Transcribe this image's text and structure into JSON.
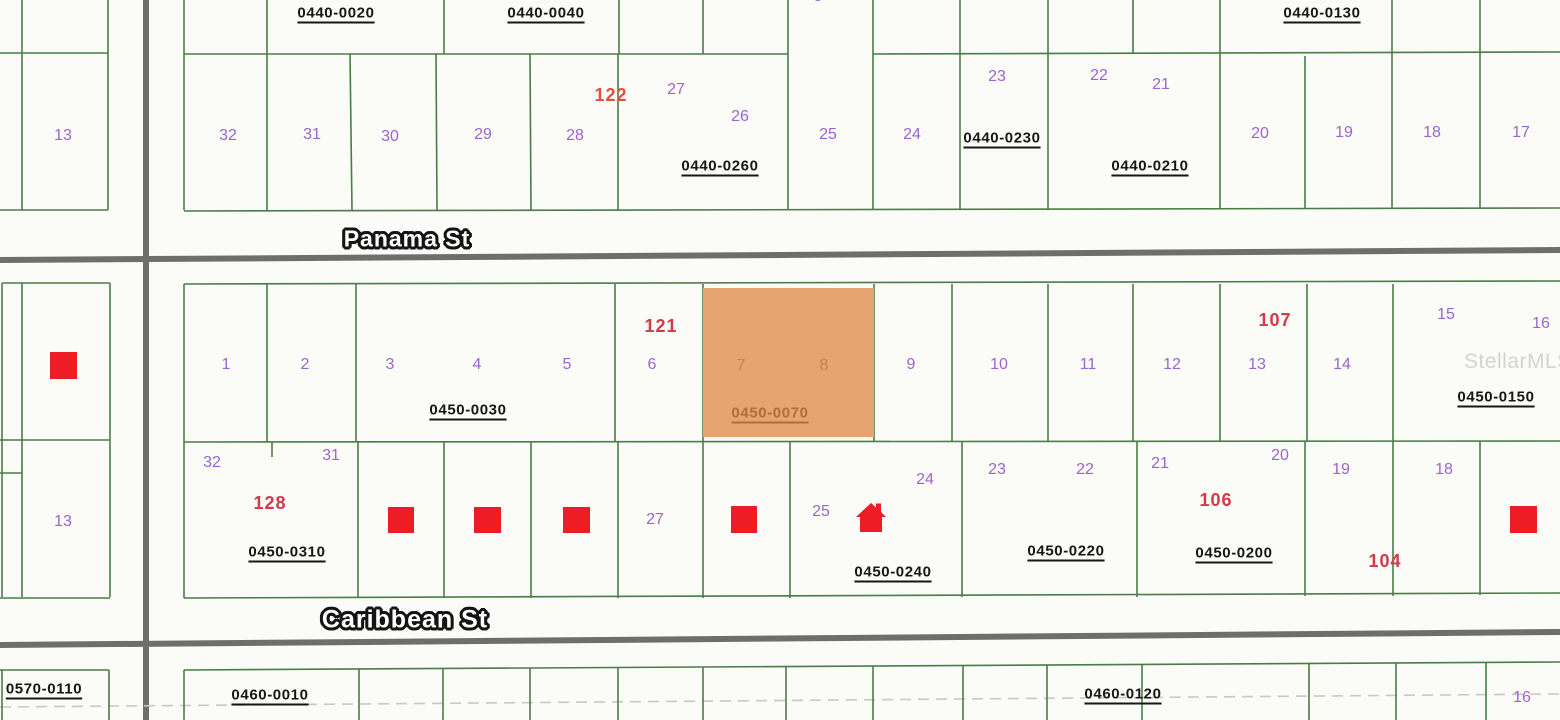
{
  "map": {
    "watermark": "StellarMLS",
    "streets": [
      {
        "name": "Panama St"
      },
      {
        "name": "Caribbean St"
      }
    ],
    "selected_parcel": {
      "id": "0450-0070",
      "fill": "#e8a470",
      "label_color": "#b06f35",
      "lots": [
        {
          "n": "7",
          "x": 741,
          "y": 366
        },
        {
          "n": "8",
          "x": 824,
          "y": 366
        }
      ]
    },
    "parcel_ids": [
      {
        "id": "0440-0020",
        "x": 336,
        "y": 13
      },
      {
        "id": "0440-0040",
        "x": 546,
        "y": 13
      },
      {
        "id": "0440-0130",
        "x": 1322,
        "y": 13
      },
      {
        "id": "0440-0260",
        "x": 720,
        "y": 166
      },
      {
        "id": "0440-0230",
        "x": 1002,
        "y": 138
      },
      {
        "id": "0440-0210",
        "x": 1150,
        "y": 166
      },
      {
        "id": "0450-0030",
        "x": 468,
        "y": 410
      },
      {
        "id": "0450-0150",
        "x": 1496,
        "y": 397
      },
      {
        "id": "0450-0310",
        "x": 287,
        "y": 552
      },
      {
        "id": "0450-0240",
        "x": 893,
        "y": 572
      },
      {
        "id": "0450-0220",
        "x": 1066,
        "y": 551
      },
      {
        "id": "0450-0200",
        "x": 1234,
        "y": 553
      },
      {
        "id": "0570-0110",
        "x": 44,
        "y": 689
      },
      {
        "id": "0460-0010",
        "x": 270,
        "y": 695
      },
      {
        "id": "0460-0120",
        "x": 1123,
        "y": 694
      }
    ],
    "lot_numbers": [
      {
        "n": "13",
        "x": 63,
        "y": 136
      },
      {
        "n": "13",
        "x": 63,
        "y": 522
      },
      {
        "n": "8",
        "x": 818,
        "y": -3
      },
      {
        "n": "32",
        "x": 228,
        "y": 136
      },
      {
        "n": "31",
        "x": 312,
        "y": 135
      },
      {
        "n": "30",
        "x": 390,
        "y": 137
      },
      {
        "n": "29",
        "x": 483,
        "y": 135
      },
      {
        "n": "28",
        "x": 575,
        "y": 136
      },
      {
        "n": "27",
        "x": 676,
        "y": 90
      },
      {
        "n": "26",
        "x": 740,
        "y": 117
      },
      {
        "n": "25",
        "x": 828,
        "y": 135
      },
      {
        "n": "24",
        "x": 912,
        "y": 135
      },
      {
        "n": "23",
        "x": 997,
        "y": 77
      },
      {
        "n": "22",
        "x": 1099,
        "y": 76
      },
      {
        "n": "21",
        "x": 1161,
        "y": 85
      },
      {
        "n": "20",
        "x": 1260,
        "y": 134
      },
      {
        "n": "19",
        "x": 1344,
        "y": 133
      },
      {
        "n": "18",
        "x": 1432,
        "y": 133
      },
      {
        "n": "17",
        "x": 1521,
        "y": 133
      },
      {
        "n": "1",
        "x": 226,
        "y": 365
      },
      {
        "n": "2",
        "x": 305,
        "y": 365
      },
      {
        "n": "3",
        "x": 390,
        "y": 365
      },
      {
        "n": "4",
        "x": 477,
        "y": 365
      },
      {
        "n": "5",
        "x": 567,
        "y": 365
      },
      {
        "n": "6",
        "x": 652,
        "y": 365
      },
      {
        "n": "9",
        "x": 911,
        "y": 365
      },
      {
        "n": "10",
        "x": 999,
        "y": 365
      },
      {
        "n": "11",
        "x": 1088,
        "y": 365
      },
      {
        "n": "12",
        "x": 1172,
        "y": 365
      },
      {
        "n": "13",
        "x": 1257,
        "y": 365
      },
      {
        "n": "14",
        "x": 1342,
        "y": 365
      },
      {
        "n": "15",
        "x": 1446,
        "y": 315
      },
      {
        "n": "16",
        "x": 1541,
        "y": 324
      },
      {
        "n": "32",
        "x": 212,
        "y": 463
      },
      {
        "n": "31",
        "x": 331,
        "y": 456
      },
      {
        "n": "27",
        "x": 655,
        "y": 520
      },
      {
        "n": "25",
        "x": 821,
        "y": 512
      },
      {
        "n": "24",
        "x": 925,
        "y": 480
      },
      {
        "n": "23",
        "x": 997,
        "y": 470
      },
      {
        "n": "22",
        "x": 1085,
        "y": 470
      },
      {
        "n": "21",
        "x": 1160,
        "y": 464
      },
      {
        "n": "20",
        "x": 1280,
        "y": 456
      },
      {
        "n": "19",
        "x": 1341,
        "y": 470
      },
      {
        "n": "18",
        "x": 1444,
        "y": 470
      },
      {
        "n": "16",
        "x": 1522,
        "y": 698
      }
    ],
    "red_numbers": [
      {
        "n": "122",
        "x": 611,
        "y": 95,
        "color": "#e0503c"
      },
      {
        "n": "121",
        "x": 661,
        "y": 326
      },
      {
        "n": "128",
        "x": 270,
        "y": 503
      },
      {
        "n": "107",
        "x": 1275,
        "y": 320
      },
      {
        "n": "106",
        "x": 1216,
        "y": 500
      },
      {
        "n": "104",
        "x": 1385,
        "y": 561
      }
    ],
    "buildings": [
      {
        "x": 50,
        "y": 352,
        "w": 27,
        "h": 27
      },
      {
        "x": 388,
        "y": 507,
        "w": 26,
        "h": 26
      },
      {
        "x": 474,
        "y": 507,
        "w": 27,
        "h": 26
      },
      {
        "x": 563,
        "y": 507,
        "w": 27,
        "h": 26
      },
      {
        "x": 731,
        "y": 506,
        "w": 26,
        "h": 27
      },
      {
        "x": 1510,
        "y": 506,
        "w": 27,
        "h": 27
      }
    ],
    "colors": {
      "lot_number": "#9c64ce",
      "red_number": "#cf3b49",
      "parcel_line": "#4a7c46",
      "road": "#6e6e6e",
      "building": "#ee1c25",
      "highlight": "#e8a470",
      "background": "#fbfbf8"
    }
  }
}
